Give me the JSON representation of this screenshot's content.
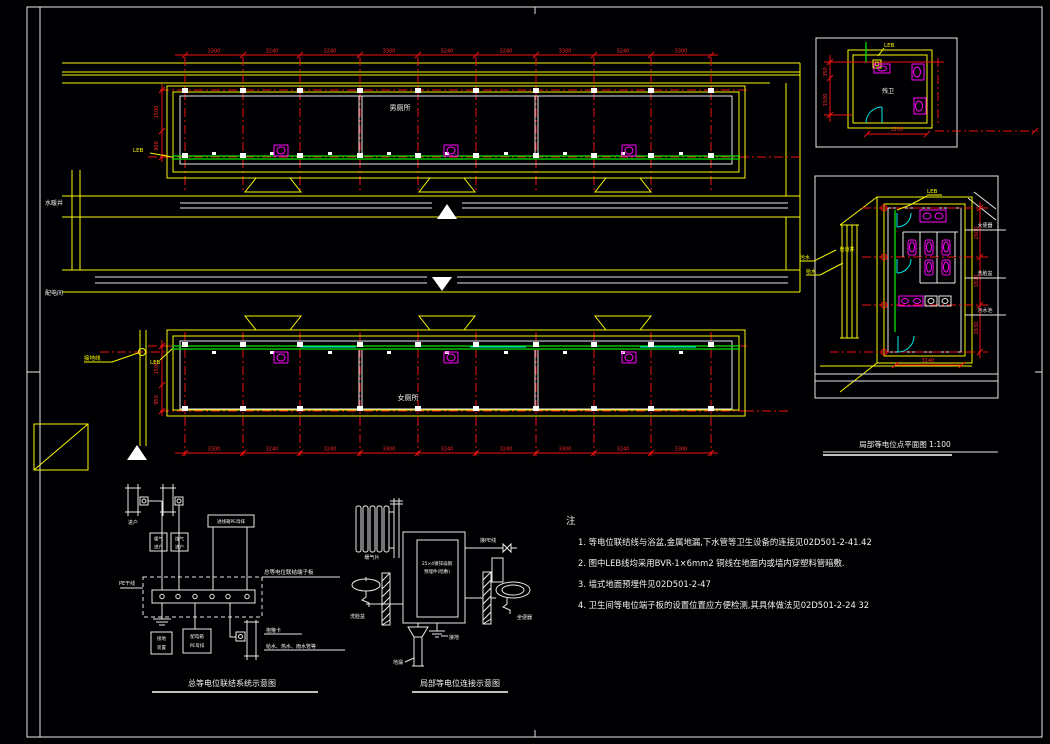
{
  "colors": {
    "wall": "#f7f700",
    "dimension": "#ef1111",
    "leb_line": "#00e400",
    "fixture": "#ff00ff",
    "door": "#00e8e8",
    "line": "#ffffff",
    "background": "#000003"
  },
  "plans": {
    "top": {
      "room_label": "男厕所",
      "leb_label": "LEB",
      "shaft_label": "水暖井",
      "dims": [
        "3300",
        "3240",
        "3240",
        "3300",
        "3240",
        "3240",
        "3300",
        "3240",
        "3300"
      ],
      "left_dims": [
        "1500",
        "900"
      ]
    },
    "bottom": {
      "room_label": "女厕所",
      "leb_label": "LEB",
      "shaft_label": "配电间",
      "ground_label": "接地线",
      "dims": [
        "3300",
        "3240",
        "3240",
        "3300",
        "3240",
        "3240",
        "3300",
        "3240",
        "3300"
      ],
      "left_dims": [
        "1500",
        "950"
      ]
    }
  },
  "detail_small": {
    "leb_label": "LEB",
    "room_label": "残卫",
    "dim_top": "350",
    "dim_left": "1500",
    "dim_bottom": "1200"
  },
  "detail_large": {
    "title": "局部等电位点平面图 1:100",
    "leb_label": "LEB",
    "shaft_label": "管道井",
    "pipe_labels": [
      "污水",
      "给水"
    ],
    "side_labels": [
      "大便器",
      "洗脸盆",
      "污水池"
    ],
    "right_dims": [
      "2600",
      "1820",
      "2630"
    ],
    "bottom_dim": "3140"
  },
  "schematic_main": {
    "title": "总等电位联结系统示意图",
    "pipe_label": "进户",
    "box1": [
      "暖气",
      "进户"
    ],
    "box2": [
      "煤气",
      "进户"
    ],
    "wide_box": "进线箱PE母排",
    "busbar_label": "总等电位联结端子板",
    "left_label": "PE干线",
    "ground_box": [
      "接地",
      "装置"
    ],
    "feeder_box": [
      "配电箱",
      "PE母排"
    ],
    "clamp_label": "抱箍卡",
    "pipes_label": "给水、热水、雨水管等"
  },
  "schematic_local": {
    "title": "局部等电位连接示意图",
    "radiator_label": "暖气片",
    "plate_line1": "25×4镀锌扁钢",
    "plate_line2": "预埋件(暗敷)",
    "pe_label": "接PE线",
    "basin_label": "洗脸盆",
    "toilet_label": "坐便器",
    "ground_label": "接地",
    "drain_label": "地漏"
  },
  "notes": {
    "header": "注",
    "items": [
      "1. 等电位联结线与浴盆,金属地漏,下水管等卫生设备的连接见02D501-2-41.42",
      "2. 图中LEB线均采用BVR-1×6mm2  铜线在地面内或墙内穿塑料管暗敷.",
      "3. 墙式地面预埋件见02D501-2-47",
      "4. 卫生间等电位端子板的设置位置应方便检测,其具体做法见02D501-2-24 32"
    ]
  }
}
